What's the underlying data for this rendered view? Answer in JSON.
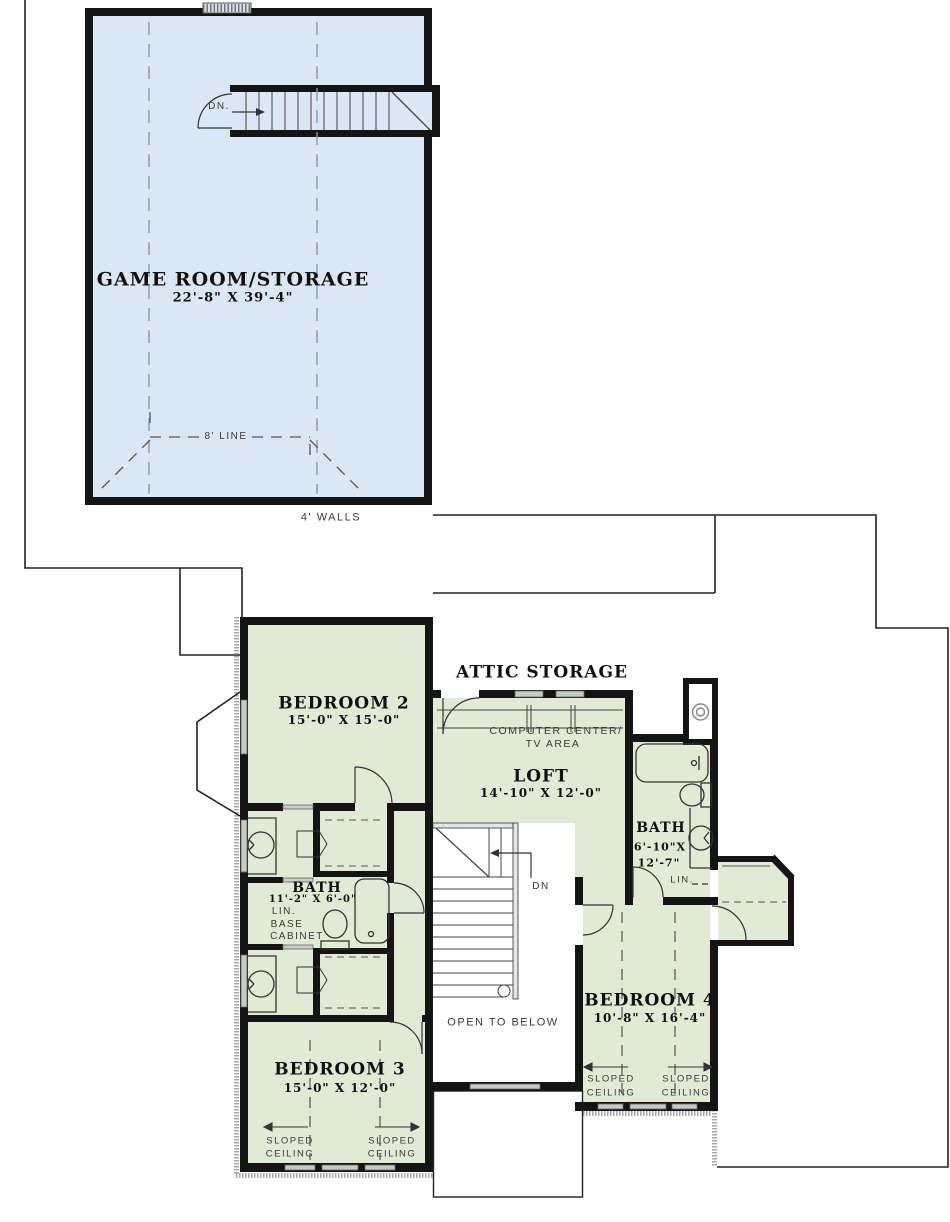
{
  "colors": {
    "wall": "#141414",
    "game_room_fill": "#dce7f5",
    "room_fill": "#e1ead4",
    "window": "#c9cfc4",
    "annotation": "#3a3a3a"
  },
  "upper_floor": {
    "game_room": {
      "name": "GAME ROOM/STORAGE",
      "dims": "22'-8\" X 39'-4\""
    },
    "stairs_dn_label": "DN.",
    "eight_foot_line_label": "8' LINE",
    "four_foot_walls_label": "4' WALLS"
  },
  "second_floor": {
    "attic_storage_label": "ATTIC STORAGE",
    "bedroom_2": {
      "name": "BEDROOM 2",
      "dims": "15'-0\" X 15'-0\""
    },
    "bedroom_3": {
      "name": "BEDROOM 3",
      "dims": "15'-0\" X 12'-0\""
    },
    "bedroom_4": {
      "name": "BEDROOM 4",
      "dims": "10'-8\" X 16'-4\""
    },
    "loft": {
      "name": "LOFT",
      "dims": "14'-10\" X 12'-0\""
    },
    "computer_center_line1": "COMPUTER CENTER/",
    "computer_center_line2": "TV AREA",
    "bath_hall": {
      "name": "BATH",
      "dims": "11'-2\" X 6'-0\""
    },
    "bath_right": {
      "name": "BATH",
      "dims_line1": "6'-10\"X",
      "dims_line2": "12'-7\""
    },
    "linen_label": "LIN.",
    "base_cabinet_line1": "LIN.",
    "base_cabinet_line2": "BASE",
    "base_cabinet_line3": "CABINET",
    "open_to_below_label": "OPEN TO BELOW",
    "stairs_dn_label": "DN",
    "sloped_label": "SLOPED",
    "ceiling_label": "CEILING"
  }
}
